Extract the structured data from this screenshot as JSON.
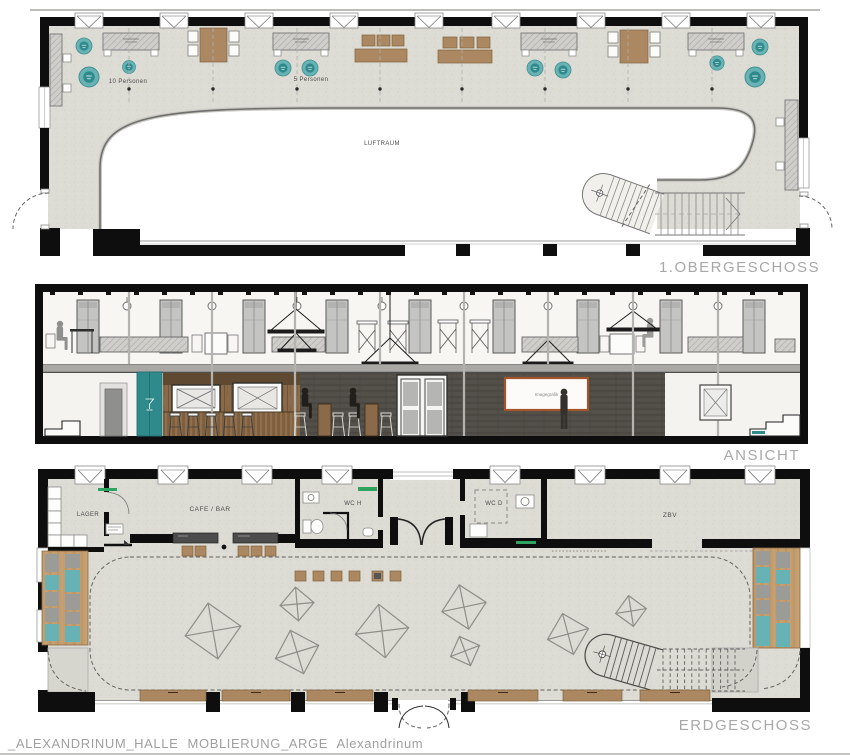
{
  "document": {
    "caption": "_ALEXANDRINUM_HALLE MOBLIERUNG_ARGE Alexandrinum"
  },
  "colors": {
    "floor": "#dcdbd4",
    "wall_black": "#0e0e0e",
    "teal": "#66b2b4",
    "teal_dark": "#2f8a8c",
    "wood_plan": "#ab8862",
    "wood_elevation": "#8a6a48",
    "wood_bench": "#c39d6e",
    "counter_dark": "#4c4c4c",
    "wall_dark_planks": "#524e48",
    "title_gray": "#a8a8a8",
    "label_dark": "#4c4c4c",
    "line_gray": "#9a9a9a",
    "green_mark": "#2fa360",
    "screen_frame": "#a3542a"
  },
  "floors": {
    "obergeschoss": {
      "title": "1.OBERGESCHOSS",
      "void_label": "LUFTRAUM",
      "seating_labels": {
        "ten": "10 Personen",
        "five": "5 Personen"
      }
    },
    "ansicht": {
      "title": "ANSICHT",
      "screen_text": "Imagegrafik"
    },
    "erdgeschoss": {
      "title": "ERDGESCHOSS",
      "rooms": {
        "lager": "LAGER",
        "cafe_bar": "CAFE / BAR",
        "wc_men": "WC H",
        "wc_women": "WC D",
        "zbv": "ZBV"
      }
    }
  }
}
